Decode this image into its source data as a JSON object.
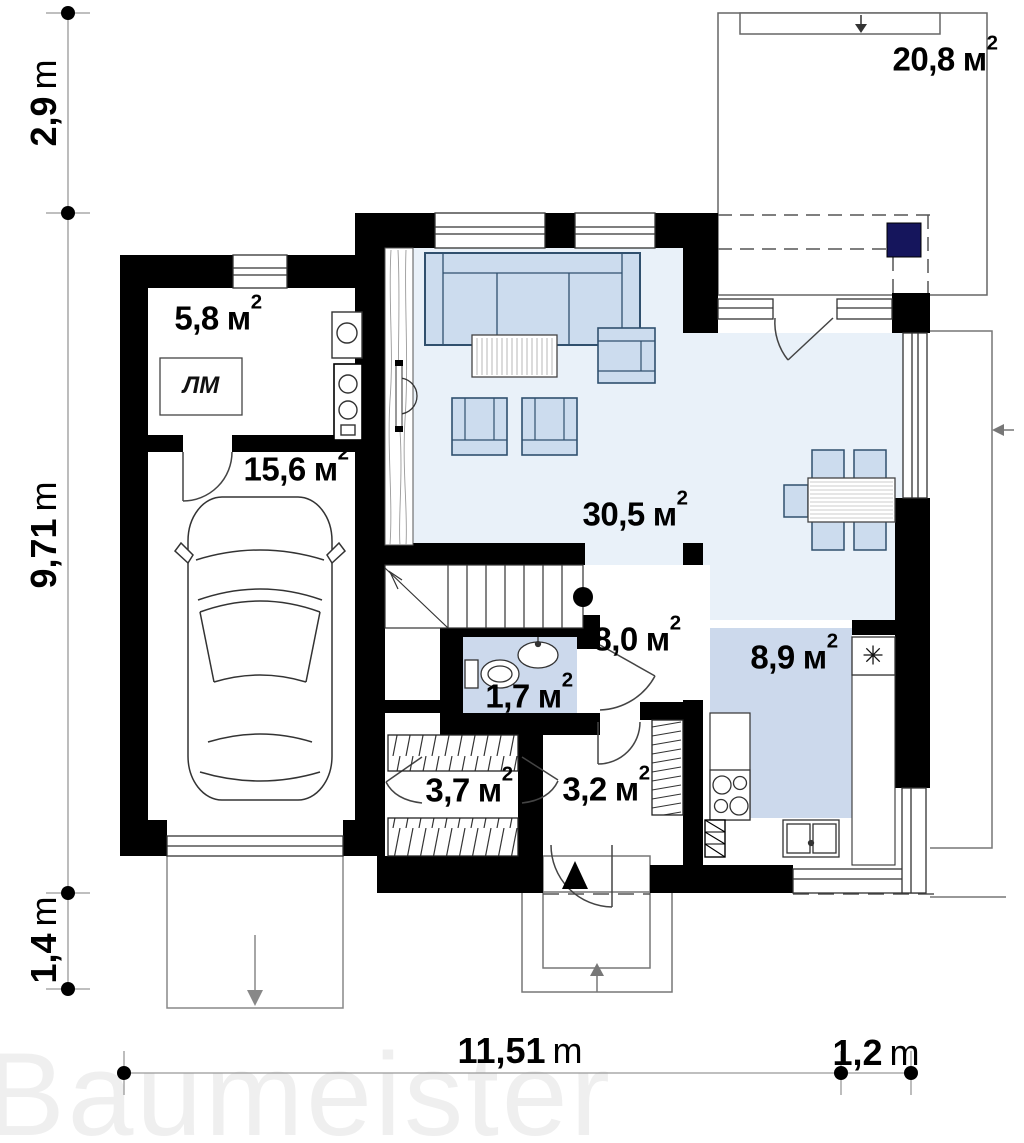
{
  "watermark": "Baumeister",
  "colors": {
    "wall": "#000000",
    "floor_living": "#e9f1f9",
    "floor_kitchen": "#ccd9ec",
    "floor_wc": "#ccd9ec",
    "furniture_fill": "#ccdcee",
    "furniture_stroke": "#30506e",
    "accent_navy": "#15155c",
    "thin_line": "#555555",
    "dimension_line": "#999999",
    "watermark_color": "#efefef"
  },
  "rooms": [
    {
      "id": "terrace",
      "area_value": "20,8",
      "area_unit": "м",
      "area_sup": "2"
    },
    {
      "id": "utility",
      "area_value": "5,8",
      "area_unit": "м",
      "area_sup": "2"
    },
    {
      "id": "garage",
      "area_value": "15,6",
      "area_unit": "м",
      "area_sup": "2"
    },
    {
      "id": "living-room",
      "area_value": "30,5",
      "area_unit": "м",
      "area_sup": "2"
    },
    {
      "id": "hall",
      "area_value": "8,0",
      "area_unit": "м",
      "area_sup": "2"
    },
    {
      "id": "wc",
      "area_value": "1,7",
      "area_unit": "м",
      "area_sup": "2"
    },
    {
      "id": "kitchen",
      "area_value": "8,9",
      "area_unit": "м",
      "area_sup": "2"
    },
    {
      "id": "wardrobe",
      "area_value": "3,7",
      "area_unit": "м",
      "area_sup": "2"
    },
    {
      "id": "entry",
      "area_value": "3,2",
      "area_unit": "м",
      "area_sup": "2"
    }
  ],
  "annotations": {
    "laundry_label": "ЛМ",
    "vent_symbol": "✳"
  },
  "dimensions": {
    "left": [
      {
        "value": "2,9",
        "unit": "m"
      },
      {
        "value": "9,71",
        "unit": "m"
      },
      {
        "value": "1,4",
        "unit": "m"
      }
    ],
    "bottom": [
      {
        "value": "11,51",
        "unit": "m"
      },
      {
        "value": "1,2",
        "unit": "m"
      }
    ]
  }
}
